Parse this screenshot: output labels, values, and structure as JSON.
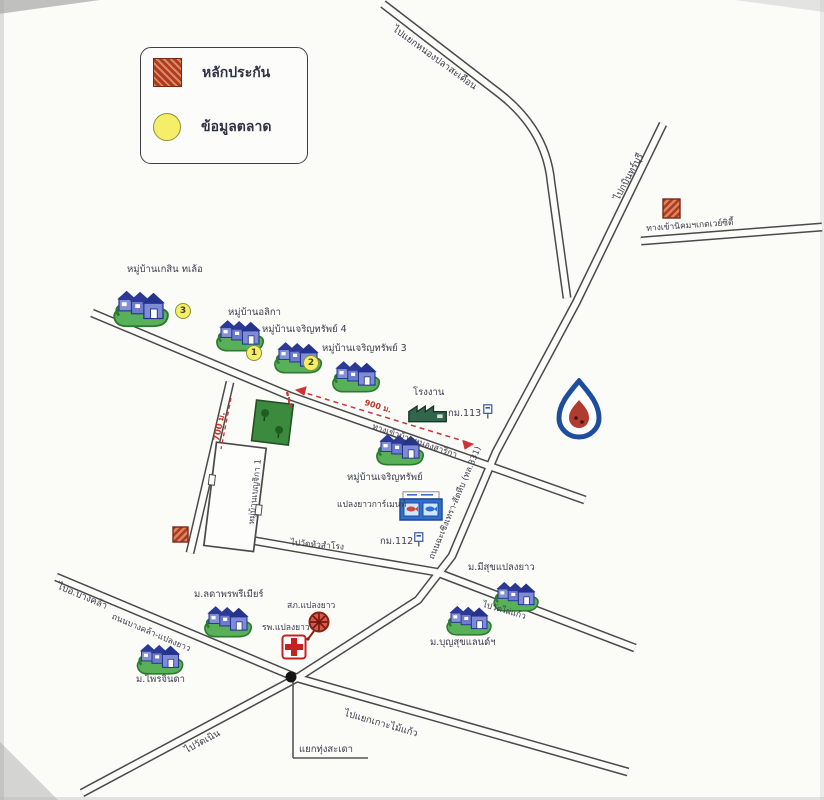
{
  "legend": {
    "collateral_label": "หลักประกัน",
    "market_label": "ข้อมูลตลาด",
    "collateral_color": "#b03a24",
    "market_color": "#f5ee69"
  },
  "roads": {
    "to_nong_pla_saduean": "ไปแยกหนองปลาสะเดือน",
    "to_kabin_buri": "ไปกบินทร์บุรี",
    "gateway_estate_entrance": "ทางเข้านิคมฯเกตเวย์ซิตี้",
    "ban_nong_sarika_entrance": "ทางเข้าบ้านหนองสาริกา",
    "highway_331": "ถนนฉะเชิงเทรา-สัตหีบ (ทล.331)",
    "to_wat_hua_samrong": "ไปวัดหัวสำโรง",
    "to_wat_phai_kaew": "ไปวัดไผ่แก้ว",
    "to_bang_khla": "ไปอ.บางคล้า",
    "bang_khla_plaeng_yao": "ถนนบางคล้า-แปลงยาว",
    "to_wat_noen": "ไปวัดเนิน",
    "to_ko_mai_kaew_junction": "ไปแยกเกาะไม้แก้ว",
    "thung_sadao_junction": "แยกทุ่งสะเดา"
  },
  "markers": {
    "km_113": "กม.113",
    "km_112": "กม.112",
    "distance_700m": "700 ม.",
    "distance_900m": "900 ม."
  },
  "places": {
    "villages": [
      {
        "name": "หมู่บ้านเกสิน ทเล้อ",
        "badge": "3"
      },
      {
        "name": "หมู่บ้านอลิกา",
        "badge": "1"
      },
      {
        "name": "หมู่บ้านเจริญทรัพย์ 4",
        "badge": "2"
      },
      {
        "name": "หมู่บ้านเจริญทรัพย์ 3"
      },
      {
        "name": "หมู่บ้านเจริญทรัพย์"
      },
      {
        "name": "ม.มีสุขแปลงยาว"
      },
      {
        "name": "ม.บุญสุขแลนด์ฯ"
      },
      {
        "name": "ม.ลดาพรพรีเมียร์"
      },
      {
        "name": "ม.ไพรจินดา"
      }
    ],
    "school_compound": "หมู่บ้านเบญจิกา 1",
    "factory": "โรงงาน",
    "garment": "แปลงยาวการ์เมนท์",
    "police_station": "สภ.แปลงยาว",
    "hospital": "รพ.แปลงยาว"
  }
}
